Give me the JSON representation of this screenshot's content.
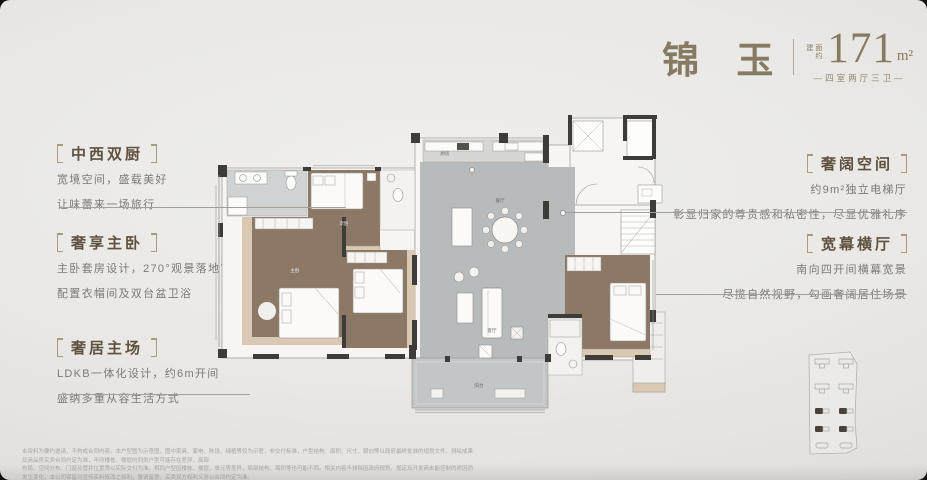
{
  "theme": {
    "accent_bronze": "#877a62",
    "callout_title_brown": "#5e5140",
    "body_text_gray": "#7b7a76",
    "wall_dark": "#3e3c39",
    "floor_gray": "#b8bbbc",
    "floor_brown": "#8d7866",
    "wood_tan": "#d9c9b3",
    "background": "#e9e8e4"
  },
  "header": {
    "name": "锦 玉",
    "area_prefix_top": "建面",
    "area_prefix_bottom": "约",
    "area_value": "171",
    "area_unit": "m²",
    "layout_label": "—四室两厅三卫—"
  },
  "callouts": {
    "left": [
      {
        "title": "中西双厨",
        "line1": "宽境空间，盛载美好",
        "line2": "让味蕾来一场旅行"
      },
      {
        "title": "奢享主卧",
        "line1": "主卧套房设计，270°观景落地窗",
        "line2": "配置衣帽间及双台盆卫浴"
      },
      {
        "title": "奢居主场",
        "line1": "LDKB一体化设计，约6m开间",
        "line2": "盛纳多重从容生活方式"
      }
    ],
    "right": [
      {
        "title": "奢阔空间",
        "line1": "约9m²独立电梯厅",
        "line2": "彰显归家的尊贵感和私密性，尽显优雅礼序"
      },
      {
        "title": "宽幕横厅",
        "line1": "南向四开间横幕宽景",
        "line2": "尽揽自然视野，勾画奢阔居住场景"
      }
    ]
  },
  "floor_plan": {
    "labels": {
      "kitchen": "厨房",
      "dining": "餐厅",
      "living": "客厅",
      "balcony": "阳台",
      "master": "主卧",
      "bedroom": "次卧"
    }
  },
  "site_map": {
    "highlight_color": "#4a423a",
    "rows": 5,
    "columns": 2,
    "highlighted_rows": [
      3,
      4
    ]
  },
  "disclaimer": {
    "line1": "本资料为要约邀请，不构成合同内容。本户型图为示意图，图中家具、家电、陈设、绿植等仅为示意，非交付标准，户型结构、面积、尺寸、朝向等以政府最终批准的规划文件、测绘成果及商品房买卖合同约定为准，不同楼栋、楼层的同类户型可能存在差异，局部",
    "line2": "布局、空间分布、门窗及管井位置等以实际交付为准。相同户型因楼栋、楼层、单元等差异，局部结构、面积等也可能不同。相关内容不排除因政府规划、规定及开发商未能控制的原因而发生变化，本公司保留对宣传资料修改之权利，敬请留意，买卖双方权利义务以合同约定为准。"
  }
}
